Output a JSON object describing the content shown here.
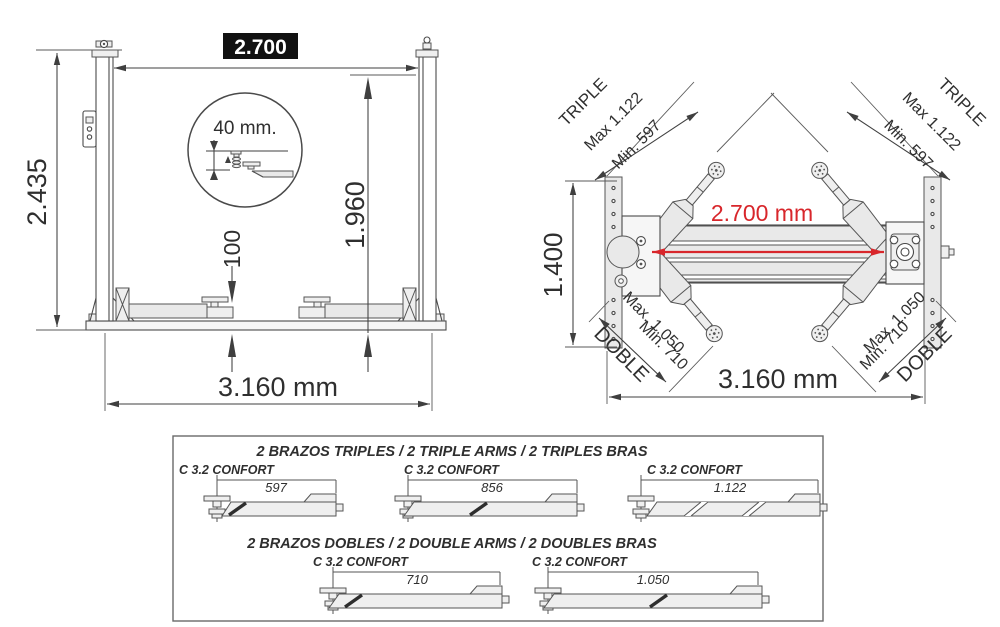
{
  "front_view": {
    "top_width": "2.700",
    "detail_note": "40 mm.",
    "total_height": "2.435",
    "lift_height": "1.960",
    "pad_min_height": "100",
    "base_width": "3.160 mm"
  },
  "top_view": {
    "arm_triple_left": {
      "title": "TRIPLE",
      "max": "Max 1.122",
      "min": "Min. 597"
    },
    "arm_triple_right": {
      "title": "TRIPLE",
      "max": "Max 1.122",
      "min": "Min. 597"
    },
    "depth": "1.400",
    "columns_distance": "2.700 mm",
    "arm_double_left": {
      "max": "Max. 1.050",
      "min": "Min. 710",
      "title": "DOBLE"
    },
    "arm_double_right": {
      "max": "Max. 1.050",
      "min": "Min. 710",
      "title": "DOBLE"
    },
    "base_width": "3.160 mm"
  },
  "arms_table": {
    "triple_title": "2 BRAZOS TRIPLES / 2 TRIPLE ARMS / 2 TRIPLES BRAS",
    "double_title": "2 BRAZOS DOBLES / 2 DOUBLE ARMS / 2 DOUBLES BRAS",
    "triple": [
      {
        "model": "C 3.2 CONFORT",
        "length": "597"
      },
      {
        "model": "C 3.2 CONFORT",
        "length": "856"
      },
      {
        "model": "C 3.2 CONFORT",
        "length": "1.122"
      }
    ],
    "double": [
      {
        "model": "C 3.2 CONFORT",
        "length": "710"
      },
      {
        "model": "C 3.2 CONFORT",
        "length": "1.050"
      }
    ]
  },
  "colors": {
    "accent_red": "#d8262b",
    "dim_label_bg": "#111111"
  }
}
